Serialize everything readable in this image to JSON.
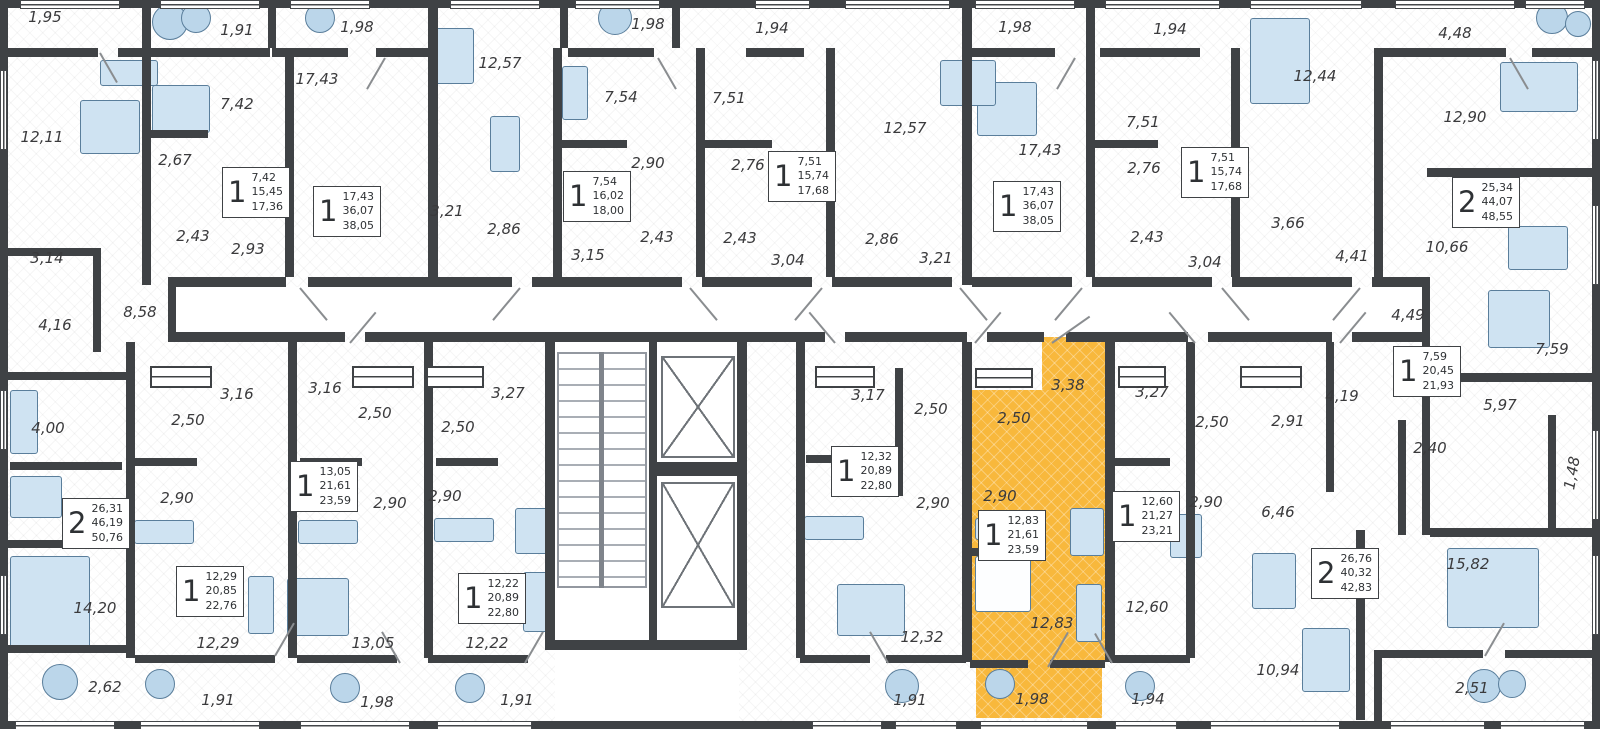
{
  "plan": {
    "kind": "residential floor plan",
    "selected_unit": {
      "rooms": "1",
      "areas": [
        "12,83",
        "21,61",
        "23,59"
      ]
    }
  },
  "colors": {
    "wall": "#3F4245",
    "highlight": "#F8B83C",
    "furniture": "#CFE3F2",
    "label": "#3A3A3C"
  },
  "room_labels": [
    {
      "text": "1,95",
      "x": 45,
      "y": 17
    },
    {
      "text": "1,91",
      "x": 237,
      "y": 30
    },
    {
      "text": "1,98",
      "x": 357,
      "y": 27
    },
    {
      "text": "12,57",
      "x": 500,
      "y": 63
    },
    {
      "text": "1,98",
      "x": 648,
      "y": 24
    },
    {
      "text": "1,94",
      "x": 772,
      "y": 28
    },
    {
      "text": "1,98",
      "x": 1015,
      "y": 27
    },
    {
      "text": "1,94",
      "x": 1170,
      "y": 29
    },
    {
      "text": "12,44",
      "x": 1315,
      "y": 76
    },
    {
      "text": "4,48",
      "x": 1455,
      "y": 33
    },
    {
      "text": "12,11",
      "x": 42,
      "y": 137
    },
    {
      "text": "7,42",
      "x": 237,
      "y": 104
    },
    {
      "text": "2,67",
      "x": 175,
      "y": 160
    },
    {
      "text": "17,43",
      "x": 317,
      "y": 79
    },
    {
      "text": "2,43",
      "x": 193,
      "y": 236
    },
    {
      "text": "2,93",
      "x": 248,
      "y": 249
    },
    {
      "text": "3,21",
      "x": 447,
      "y": 211
    },
    {
      "text": "2,86",
      "x": 504,
      "y": 229
    },
    {
      "text": "3,15",
      "x": 588,
      "y": 255
    },
    {
      "text": "7,54",
      "x": 621,
      "y": 97
    },
    {
      "text": "2,90",
      "x": 648,
      "y": 163
    },
    {
      "text": "2,43",
      "x": 657,
      "y": 237
    },
    {
      "text": "7,51",
      "x": 729,
      "y": 98
    },
    {
      "text": "2,76",
      "x": 748,
      "y": 165
    },
    {
      "text": "2,43",
      "x": 740,
      "y": 238
    },
    {
      "text": "3,04",
      "x": 788,
      "y": 260
    },
    {
      "text": "12,57",
      "x": 905,
      "y": 128
    },
    {
      "text": "17,43",
      "x": 1040,
      "y": 150
    },
    {
      "text": "2,86",
      "x": 882,
      "y": 239
    },
    {
      "text": "3,21",
      "x": 936,
      "y": 258
    },
    {
      "text": "7,51",
      "x": 1143,
      "y": 122
    },
    {
      "text": "2,76",
      "x": 1144,
      "y": 168
    },
    {
      "text": "2,43",
      "x": 1147,
      "y": 237
    },
    {
      "text": "3,04",
      "x": 1205,
      "y": 262
    },
    {
      "text": "3,66",
      "x": 1288,
      "y": 223
    },
    {
      "text": "4,41",
      "x": 1352,
      "y": 256
    },
    {
      "text": "12,90",
      "x": 1465,
      "y": 117
    },
    {
      "text": "10,66",
      "x": 1447,
      "y": 247
    },
    {
      "text": "3,14",
      "x": 47,
      "y": 258
    },
    {
      "text": "4,16",
      "x": 55,
      "y": 325
    },
    {
      "text": "8,58",
      "x": 140,
      "y": 312
    },
    {
      "text": "4,00",
      "x": 48,
      "y": 428
    },
    {
      "text": "3,16",
      "x": 237,
      "y": 394
    },
    {
      "text": "3,16",
      "x": 325,
      "y": 388
    },
    {
      "text": "3,27",
      "x": 508,
      "y": 393
    },
    {
      "text": "2,50",
      "x": 188,
      "y": 420
    },
    {
      "text": "2,50",
      "x": 375,
      "y": 413
    },
    {
      "text": "2,50",
      "x": 458,
      "y": 427
    },
    {
      "text": "2,90",
      "x": 177,
      "y": 498
    },
    {
      "text": "2,90",
      "x": 390,
      "y": 503
    },
    {
      "text": "2,90",
      "x": 445,
      "y": 496
    },
    {
      "text": "14,20",
      "x": 95,
      "y": 608
    },
    {
      "text": "2,62",
      "x": 105,
      "y": 687
    },
    {
      "text": "12,29",
      "x": 218,
      "y": 643
    },
    {
      "text": "1,91",
      "x": 218,
      "y": 700
    },
    {
      "text": "13,05",
      "x": 373,
      "y": 643
    },
    {
      "text": "1,98",
      "x": 377,
      "y": 702
    },
    {
      "text": "12,22",
      "x": 487,
      "y": 643
    },
    {
      "text": "1,91",
      "x": 517,
      "y": 700
    },
    {
      "text": "3,17",
      "x": 868,
      "y": 395
    },
    {
      "text": "2,50",
      "x": 931,
      "y": 409
    },
    {
      "text": "2,50",
      "x": 1014,
      "y": 418
    },
    {
      "text": "3,38",
      "x": 1068,
      "y": 385
    },
    {
      "text": "2,90",
      "x": 933,
      "y": 503
    },
    {
      "text": "2,90",
      "x": 1000,
      "y": 496
    },
    {
      "text": "12,32",
      "x": 922,
      "y": 637
    },
    {
      "text": "1,91",
      "x": 910,
      "y": 700
    },
    {
      "text": "12,83",
      "x": 1052,
      "y": 623
    },
    {
      "text": "1,98",
      "x": 1032,
      "y": 699
    },
    {
      "text": "3,27",
      "x": 1152,
      "y": 392
    },
    {
      "text": "2,50",
      "x": 1212,
      "y": 422
    },
    {
      "text": "2,91",
      "x": 1288,
      "y": 421
    },
    {
      "text": "4,19",
      "x": 1342,
      "y": 396
    },
    {
      "text": "4,49",
      "x": 1408,
      "y": 315
    },
    {
      "text": "7,59",
      "x": 1552,
      "y": 349
    },
    {
      "text": "5,97",
      "x": 1500,
      "y": 405
    },
    {
      "text": "2,40",
      "x": 1430,
      "y": 448
    },
    {
      "text": "1,48",
      "x": 1572,
      "y": 473,
      "rot": true
    },
    {
      "text": "2,90",
      "x": 1206,
      "y": 502
    },
    {
      "text": "6,46",
      "x": 1278,
      "y": 512
    },
    {
      "text": "12,60",
      "x": 1147,
      "y": 607
    },
    {
      "text": "1,94",
      "x": 1148,
      "y": 699
    },
    {
      "text": "10,94",
      "x": 1278,
      "y": 670
    },
    {
      "text": "15,82",
      "x": 1468,
      "y": 564
    },
    {
      "text": "2,51",
      "x": 1472,
      "y": 688
    }
  ],
  "unit_cards": [
    {
      "rooms": "1",
      "areas": [
        "7,42",
        "15,45",
        "17,36"
      ],
      "x": 222,
      "y": 167,
      "highlighted": false
    },
    {
      "rooms": "1",
      "areas": [
        "17,43",
        "36,07",
        "38,05"
      ],
      "x": 313,
      "y": 186,
      "highlighted": false
    },
    {
      "rooms": "1",
      "areas": [
        "7,54",
        "16,02",
        "18,00"
      ],
      "x": 563,
      "y": 171,
      "highlighted": false
    },
    {
      "rooms": "1",
      "areas": [
        "7,51",
        "15,74",
        "17,68"
      ],
      "x": 768,
      "y": 151,
      "highlighted": false
    },
    {
      "rooms": "1",
      "areas": [
        "17,43",
        "36,07",
        "38,05"
      ],
      "x": 993,
      "y": 181,
      "highlighted": false
    },
    {
      "rooms": "1",
      "areas": [
        "7,51",
        "15,74",
        "17,68"
      ],
      "x": 1181,
      "y": 147,
      "highlighted": false
    },
    {
      "rooms": "2",
      "areas": [
        "25,34",
        "44,07",
        "48,55"
      ],
      "x": 1452,
      "y": 177,
      "highlighted": false
    },
    {
      "rooms": "2",
      "areas": [
        "26,31",
        "46,19",
        "50,76"
      ],
      "x": 62,
      "y": 498,
      "highlighted": false
    },
    {
      "rooms": "1",
      "areas": [
        "13,05",
        "21,61",
        "23,59"
      ],
      "x": 290,
      "y": 461,
      "highlighted": false
    },
    {
      "rooms": "1",
      "areas": [
        "12,29",
        "20,85",
        "22,76"
      ],
      "x": 176,
      "y": 566,
      "highlighted": false
    },
    {
      "rooms": "1",
      "areas": [
        "12,22",
        "20,89",
        "22,80"
      ],
      "x": 458,
      "y": 573,
      "highlighted": false
    },
    {
      "rooms": "1",
      "areas": [
        "12,32",
        "20,89",
        "22,80"
      ],
      "x": 831,
      "y": 446,
      "highlighted": false
    },
    {
      "rooms": "1",
      "areas": [
        "12,83",
        "21,61",
        "23,59"
      ],
      "x": 978,
      "y": 510,
      "highlighted": true
    },
    {
      "rooms": "1",
      "areas": [
        "12,60",
        "21,27",
        "23,21"
      ],
      "x": 1112,
      "y": 491,
      "highlighted": false
    },
    {
      "rooms": "2",
      "areas": [
        "26,76",
        "40,32",
        "42,83"
      ],
      "x": 1311,
      "y": 548,
      "highlighted": false
    },
    {
      "rooms": "1",
      "areas": [
        "7,59",
        "20,45",
        "21,93"
      ],
      "x": 1393,
      "y": 346,
      "highlighted": false
    }
  ]
}
